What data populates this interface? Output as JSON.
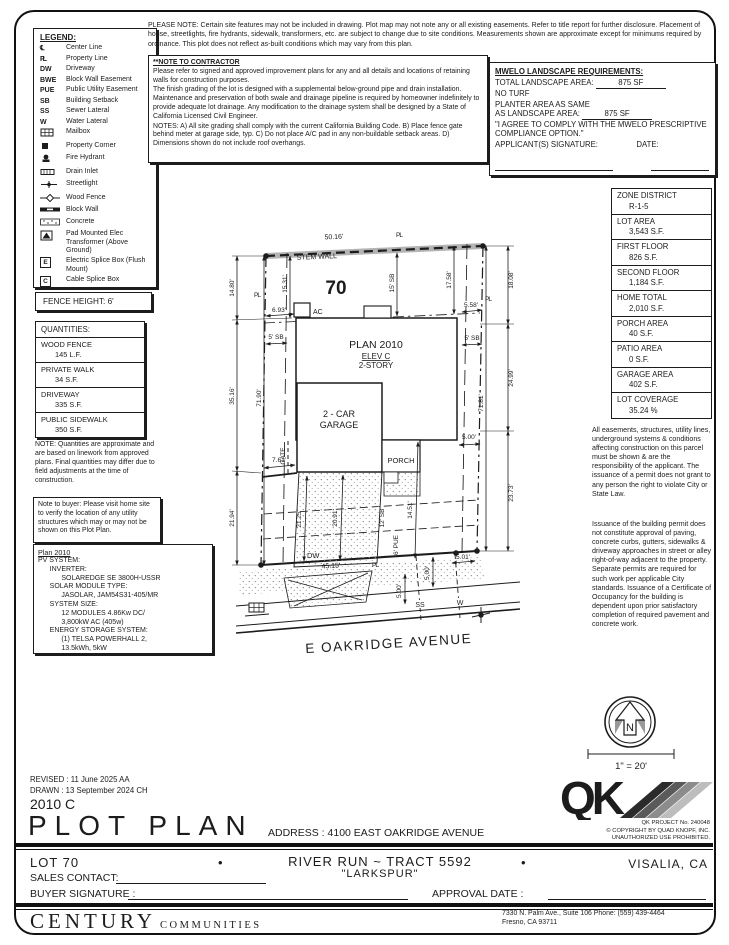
{
  "colors": {
    "paper": "#ffffff",
    "ink": "#1c1c1c",
    "stem_wall_gray": "#b3b3b3",
    "stipple_gray": "#8a8a8a",
    "qk_stripe_grays": [
      "#2b2b2b",
      "#5a5a5a",
      "#8c8c8c",
      "#bdbdbd"
    ]
  },
  "legend": {
    "title": "LEGEND:",
    "items": [
      {
        "icon": "centerline-icon",
        "label": "Center Line"
      },
      {
        "icon": "propertyline-icon",
        "label": "Property Line"
      },
      {
        "sym": "DW",
        "label": "Driveway"
      },
      {
        "sym": "BWE",
        "label": "Block Wall Easement"
      },
      {
        "sym": "PUE",
        "label": "Public Utility Easement"
      },
      {
        "sym": "SB",
        "label": "Building Setback"
      },
      {
        "sym": "SS",
        "label": "Sewer Lateral"
      },
      {
        "sym": "W",
        "label": "Water Lateral"
      },
      {
        "icon": "mailbox-icon",
        "label": "Mailbox"
      },
      {
        "icon": "property-corner-icon",
        "label": "Property Corner"
      },
      {
        "icon": "fire-hydrant-icon",
        "label": "Fire Hydrant"
      },
      {
        "icon": "drain-inlet-icon",
        "label": "Drain Inlet"
      },
      {
        "icon": "streetlight-icon",
        "label": "Streetlight"
      },
      {
        "icon": "wood-fence-icon",
        "label": "Wood Fence"
      },
      {
        "icon": "block-wall-icon",
        "label": "Block Wall"
      },
      {
        "icon": "concrete-icon",
        "label": "Concrete"
      },
      {
        "icon": "transformer-icon",
        "label": "Pad Mounted Elec Transformer (Above Ground)"
      },
      {
        "sym": "E",
        "label": "Electric Splice Box (Flush Mount)"
      },
      {
        "sym": "C",
        "label": "Cable Splice Box"
      }
    ]
  },
  "please_note": "PLEASE NOTE:  Certain site features may not be included in drawing.  Plot map may not note any or all existing easements.  Refer to title report for further disclosure.  Placement of house, streetlights, fire hydrants, sidewalk, transformers, etc. are subject to change due to site conditions.  Measurements shown are approximate except for minimums required by ordinance.  This plot does not reflect as-built conditions which may vary from this plan.",
  "contractor_note": {
    "title": "**NOTE TO CONTRACTOR",
    "paragraphs": [
      "Please refer to signed and approved improvement plans for any and all details and locations of retaining walls for construction purposes.",
      "The finish grading of the lot is designed with a supplemental below-ground pipe and drain installation.  Maintenance and preservation of both swale and drainage pipeline is required by homeowner indefinitely to provide adequate lot drainage.  Any modification to the drainage system shall be designed by a State of California Licensed Civil Engineer.",
      "NOTES:  A) All site grading shall comply with the current California Building Code.  B) Place fence gate behind meter at garage side, typ.  C) Do not place A/C pad in any non-buildable setback areas.  D) Dimensions shown do not include roof overhangs."
    ]
  },
  "mwelo": {
    "title": "MWELO LANDSCAPE REQUIREMENTS:",
    "total_label": "TOTAL LANDSCAPE AREA:",
    "total_value": "875 SF",
    "no_turf": "NO TURF",
    "planter_line1": "PLANTER AREA AS SAME",
    "planter_line2": "AS LANDSCAPE AREA:",
    "planter_value": "875 SF",
    "agreement": "\"I AGREE TO COMPLY WITH THE MWELO PRESCRIPTIVE COMPLIANCE OPTION.\"",
    "signature_label": "APPLICANT(S) SIGNATURE:",
    "date_label": "DATE:"
  },
  "zone_table": {
    "rows": [
      {
        "label": "ZONE DISTRICT",
        "value": "R-1-5"
      },
      {
        "label": "LOT AREA",
        "value": "3,543 S.F."
      },
      {
        "label": "FIRST FLOOR",
        "value": "826 S.F."
      },
      {
        "label": "SECOND FLOOR",
        "value": "1,184 S.F."
      },
      {
        "label": "HOME TOTAL",
        "value": "2,010 S.F."
      },
      {
        "label": "PORCH AREA",
        "value": "40 S.F."
      },
      {
        "label": "PATIO AREA",
        "value": "0 S.F."
      },
      {
        "label": "GARAGE AREA",
        "value": "402 S.F."
      },
      {
        "label": "LOT COVERAGE",
        "value": "35.24 %"
      }
    ]
  },
  "fence_height": "FENCE HEIGHT: 6'",
  "quantities": {
    "title": "QUANTITIES:",
    "rows": [
      {
        "label": "WOOD FENCE",
        "value": "145 L.F."
      },
      {
        "label": "PRIVATE WALK",
        "value": "34 S.F."
      },
      {
        "label": "DRIVEWAY",
        "value": "335 S.F."
      },
      {
        "label": "PUBLIC SIDEWALK",
        "value": "350 S.F."
      }
    ]
  },
  "quantities_note": "NOTE: Quantities are  approximate and are based on linework from approved plans.  Final quantities may differ due to field adjustments at the time of construction.",
  "buyer_note": "Note to buyer: Please visit home site to verify the location of any utility structures which may or may not be shown on this Plot Plan.",
  "pv": {
    "title": "Plan 2010",
    "lines": [
      "PV SYSTEM:",
      "      INVERTER:",
      "            SOLAREDGE SE 3800H-USSR",
      "      SOLAR MODULE TYPE:",
      "            JASOLAR, JAM54S31-405/MR",
      "      SYSTEM SIZE:",
      "            12 MODULES 4.86Kw DC/",
      "            3,800kW AC (405w)",
      "      ENERGY STORAGE SYSTEM:",
      "            (1) TELSA POWERHALL 2,",
      "            13.5kWh, 5kW"
    ]
  },
  "right_notes": {
    "para1": "All easements, structures, utility lines, underground systems & conditions affecting construction on this parcel must be shown & are the responsibility of the applicant. The issuance of a permit does not grant to any person the right to violate City or State Law.",
    "para2": "Issuance of the building permit does not constitute approval of paving, concrete curbs, gutters, sidewalks & driveway approaches in street or alley right-of-way adjacent to the property. Separate permits are required for such work per applicable City standards. Issuance of a Certificate of Occupancy for the building is dependent upon prior satisfactory completion of required pavement and concrete work."
  },
  "compass": {
    "north": "N",
    "scale": "1\" = 20'"
  },
  "qk": {
    "letters": "QK",
    "project": "QK PROJECT No. 240048",
    "copyright": "©  COPYRIGHT BY QUAD KNOPF, INC.",
    "use": "UNAUTHORIZED USE PROHIBITED."
  },
  "titleblock": {
    "revised": "REVISED :  11 June 2025   AA",
    "drawn": "DRAWN :  13 September 2024   CH",
    "plan_code": "2010  C",
    "title": "PLOT PLAN",
    "address": "ADDRESS :  4100 EAST OAKRIDGE AVENUE",
    "lot": "LOT 70",
    "bullet": "•",
    "tract": "RIVER RUN ~ TRACT 5592",
    "model": "\"LARKSPUR\"",
    "city": "VISALIA, CA",
    "sales_contact": "SALES CONTACT:",
    "buyer_signature": "BUYER SIGNATURE :",
    "approval_date": "APPROVAL DATE :",
    "brand": "CENTURY",
    "brand2": "COMMUNITIES",
    "office_addr": "7330 N. Palm Ave., Suite 106    Phone:  (559) 439-4464",
    "office_city": "Fresno, CA  93711"
  },
  "plot": {
    "lot_number": "70",
    "stem_wall": "STEM WALL",
    "plan": "PLAN 2010",
    "elev": "ELEV C",
    "story": "2-STORY",
    "garage1": "2 - CAR",
    "garage2": "GARAGE",
    "porch": "PORCH",
    "gate": "GATE",
    "ac": "AC",
    "dw": "DW",
    "ss": "SS",
    "w": "W",
    "pl": "PL",
    "street": "E OAKRIDGE AVENUE",
    "d_top": "50.16'",
    "d_l1": "14.80'",
    "d_l2": "35.16'",
    "d_l3": "21.94'",
    "d_lin": "71.90'",
    "d_lsub": "15.31'",
    "d_r1": "18.08'",
    "d_r2": "24.99'",
    "d_r3": "23.73'",
    "d_rin": "71.81'",
    "d_rsub": "17.58'",
    "d_rear_sb": "15' SB",
    "d_sb_l": "5' SB",
    "d_sb_r": "5' SB",
    "d_ac": "6.93'",
    "d_roff": "5.58'",
    "d_gate": "7.61'",
    "d_drv_l": "21.25'",
    "d_drv": "20.91'",
    "d_fsb": "12' SB",
    "d_pue": "6' PUE",
    "d_walk": "14.51'",
    "d_step": "5.00'",
    "d_apron": "5.00'",
    "d_sewer": "5.00'",
    "d_water": "5.01'",
    "d_front": "45.15'"
  }
}
